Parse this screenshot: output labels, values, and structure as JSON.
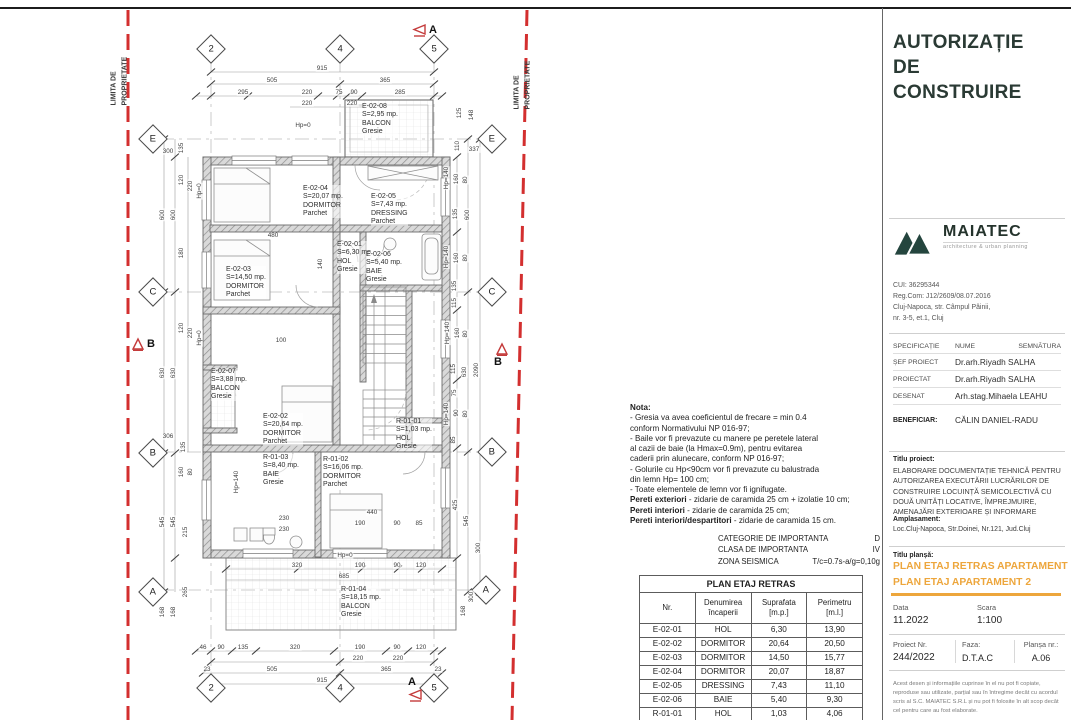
{
  "plan": {
    "property_line_label": "LIMITA DE\nPROPRIETATE",
    "colors": {
      "property_line_red": "#D32F2F",
      "wall_gray": "#6a6a6a"
    },
    "sections": [
      {
        "label": "A"
      },
      {
        "label": "A"
      },
      {
        "label": "B"
      },
      {
        "label": "B"
      }
    ],
    "grid_markers": [
      {
        "label": "2",
        "x": 211,
        "y": 49
      },
      {
        "label": "4",
        "x": 340,
        "y": 49
      },
      {
        "label": "5",
        "x": 434,
        "y": 49
      },
      {
        "label": "2",
        "x": 211,
        "y": 688
      },
      {
        "label": "4",
        "x": 340,
        "y": 688
      },
      {
        "label": "5",
        "x": 434,
        "y": 688
      },
      {
        "label": "E",
        "x": 153,
        "y": 139
      },
      {
        "label": "C",
        "x": 153,
        "y": 292
      },
      {
        "label": "B",
        "x": 153,
        "y": 453
      },
      {
        "label": "A",
        "x": 153,
        "y": 592
      },
      {
        "label": "E",
        "x": 492,
        "y": 139
      },
      {
        "label": "C",
        "x": 492,
        "y": 292
      },
      {
        "label": "B",
        "x": 492,
        "y": 452
      },
      {
        "label": "A",
        "x": 486,
        "y": 590
      }
    ],
    "rooms": [
      {
        "id": "E-02-08",
        "area": "S=2,95 mp.",
        "name": "BALCON",
        "finish": "Gresie",
        "x": 362,
        "y": 103
      },
      {
        "id": "E-02-04",
        "area": "S=20,07 mp.",
        "name": "DORMITOR",
        "finish": "Parchet",
        "x": 303,
        "y": 185
      },
      {
        "id": "E-02-05",
        "area": "S=7,43 mp.",
        "name": "DRESSING",
        "finish": "Parchet",
        "x": 371,
        "y": 193
      },
      {
        "id": "E-02-01",
        "area": "S=6,30 mp.",
        "name": "HOL",
        "finish": "Gresie",
        "x": 337,
        "y": 241
      },
      {
        "id": "E-02-06",
        "area": "S=5,40 mp.",
        "name": "BAIE",
        "finish": "Gresie",
        "x": 366,
        "y": 251
      },
      {
        "id": "E-02-03",
        "area": "S=14,50 mp.",
        "name": "DORMITOR",
        "finish": "Parchet",
        "x": 226,
        "y": 266
      },
      {
        "id": "E-02-07",
        "area": "S=3,88 mp.",
        "name": "BALCON",
        "finish": "Gresie",
        "x": 211,
        "y": 368
      },
      {
        "id": "E-02-02",
        "area": "S=20,64 mp.",
        "name": "DORMITOR",
        "finish": "Parchet",
        "x": 263,
        "y": 413
      },
      {
        "id": "R-01-03",
        "area": "S=8,40 mp.",
        "name": "BAIE",
        "finish": "Gresie",
        "x": 263,
        "y": 454
      },
      {
        "id": "R-01-02",
        "area": "S=16,06 mp.",
        "name": "DORMITOR",
        "finish": "Parchet",
        "x": 323,
        "y": 456
      },
      {
        "id": "R-01-01",
        "area": "S=1,03 mp.",
        "name": "HOL",
        "finish": "Gresie",
        "x": 396,
        "y": 418
      },
      {
        "id": "R-01-04",
        "area": "S=18,15 mp.",
        "name": "BALCON",
        "finish": "Gresie",
        "x": 341,
        "y": 586
      }
    ],
    "dims": [
      {
        "t": "915",
        "x": 322,
        "y": 69
      },
      {
        "t": "505",
        "x": 272,
        "y": 81
      },
      {
        "t": "365",
        "x": 385,
        "y": 81
      },
      {
        "t": "295",
        "x": 243,
        "y": 93
      },
      {
        "t": "220",
        "x": 307,
        "y": 93
      },
      {
        "t": "75",
        "x": 339,
        "y": 93
      },
      {
        "t": "90",
        "x": 354,
        "y": 93
      },
      {
        "t": "285",
        "x": 400,
        "y": 93
      },
      {
        "t": "220",
        "x": 307,
        "y": 104
      },
      {
        "t": "220",
        "x": 352,
        "y": 104
      },
      {
        "t": "337",
        "x": 474,
        "y": 150
      },
      {
        "t": "Hp=0",
        "x": 303,
        "y": 126
      },
      {
        "t": "480",
        "x": 273,
        "y": 236
      },
      {
        "t": "140",
        "x": 321,
        "y": 264,
        "rot": -90
      },
      {
        "t": "100",
        "x": 281,
        "y": 341
      },
      {
        "t": "440",
        "x": 372,
        "y": 513
      },
      {
        "t": "190",
        "x": 360,
        "y": 524
      },
      {
        "t": "90",
        "x": 397,
        "y": 524
      },
      {
        "t": "85",
        "x": 419,
        "y": 524
      },
      {
        "t": "230",
        "x": 284,
        "y": 519
      },
      {
        "t": "230",
        "x": 284,
        "y": 530
      },
      {
        "t": "Hp=0",
        "x": 345,
        "y": 556
      },
      {
        "t": "320",
        "x": 297,
        "y": 566
      },
      {
        "t": "190",
        "x": 360,
        "y": 566
      },
      {
        "t": "90",
        "x": 397,
        "y": 566
      },
      {
        "t": "120",
        "x": 421,
        "y": 566
      },
      {
        "t": "685",
        "x": 344,
        "y": 577
      },
      {
        "t": "46",
        "x": 203,
        "y": 648
      },
      {
        "t": "90",
        "x": 221,
        "y": 648
      },
      {
        "t": "135",
        "x": 243,
        "y": 648
      },
      {
        "t": "320",
        "x": 295,
        "y": 648
      },
      {
        "t": "190",
        "x": 360,
        "y": 648
      },
      {
        "t": "90",
        "x": 397,
        "y": 648
      },
      {
        "t": "120",
        "x": 421,
        "y": 648
      },
      {
        "t": "220",
        "x": 358,
        "y": 659
      },
      {
        "t": "220",
        "x": 398,
        "y": 659
      },
      {
        "t": "23",
        "x": 207,
        "y": 670
      },
      {
        "t": "505",
        "x": 272,
        "y": 670
      },
      {
        "t": "365",
        "x": 386,
        "y": 670
      },
      {
        "t": "23",
        "x": 438,
        "y": 670
      },
      {
        "t": "915",
        "x": 322,
        "y": 681
      },
      {
        "t": "300",
        "x": 168,
        "y": 152
      },
      {
        "t": "135",
        "x": 182,
        "y": 148,
        "rot": -90
      },
      {
        "t": "600",
        "x": 163,
        "y": 215,
        "rot": -90
      },
      {
        "t": "600",
        "x": 174,
        "y": 215,
        "rot": -90
      },
      {
        "t": "120",
        "x": 182,
        "y": 180,
        "rot": -90
      },
      {
        "t": "220",
        "x": 191,
        "y": 186,
        "rot": -90
      },
      {
        "t": "Hp=0",
        "x": 200,
        "y": 191,
        "rot": -90
      },
      {
        "t": "180",
        "x": 182,
        "y": 253,
        "rot": -90
      },
      {
        "t": "120",
        "x": 182,
        "y": 328,
        "rot": -90
      },
      {
        "t": "220",
        "x": 191,
        "y": 333,
        "rot": -90
      },
      {
        "t": "Hp=0",
        "x": 200,
        "y": 338,
        "rot": -90
      },
      {
        "t": "630",
        "x": 163,
        "y": 373,
        "rot": -90
      },
      {
        "t": "630",
        "x": 174,
        "y": 373,
        "rot": -90
      },
      {
        "t": "306",
        "x": 168,
        "y": 437
      },
      {
        "t": "135",
        "x": 184,
        "y": 447,
        "rot": -90
      },
      {
        "t": "160",
        "x": 182,
        "y": 472,
        "rot": -90
      },
      {
        "t": "80",
        "x": 191,
        "y": 472,
        "rot": -90
      },
      {
        "t": "545",
        "x": 163,
        "y": 522,
        "rot": -90
      },
      {
        "t": "545",
        "x": 174,
        "y": 522,
        "rot": -90
      },
      {
        "t": "215",
        "x": 186,
        "y": 532,
        "rot": -90
      },
      {
        "t": "265",
        "x": 186,
        "y": 592,
        "rot": -90
      },
      {
        "t": "168",
        "x": 163,
        "y": 612,
        "rot": -90
      },
      {
        "t": "168",
        "x": 174,
        "y": 612,
        "rot": -90
      },
      {
        "t": "Hp=140",
        "x": 237,
        "y": 482,
        "rot": -90
      },
      {
        "t": "125",
        "x": 460,
        "y": 113,
        "rot": -90
      },
      {
        "t": "148",
        "x": 472,
        "y": 115,
        "rot": -90
      },
      {
        "t": "110",
        "x": 458,
        "y": 146,
        "rot": -90
      },
      {
        "t": "Hp=140",
        "x": 447,
        "y": 178,
        "rot": -90
      },
      {
        "t": "160",
        "x": 457,
        "y": 179,
        "rot": -90
      },
      {
        "t": "80",
        "x": 466,
        "y": 180,
        "rot": -90
      },
      {
        "t": "135",
        "x": 456,
        "y": 214,
        "rot": -90
      },
      {
        "t": "600",
        "x": 468,
        "y": 215,
        "rot": -90
      },
      {
        "t": "Hp=140",
        "x": 447,
        "y": 257,
        "rot": -90
      },
      {
        "t": "160",
        "x": 457,
        "y": 258,
        "rot": -90
      },
      {
        "t": "80",
        "x": 466,
        "y": 258,
        "rot": -90
      },
      {
        "t": "135",
        "x": 455,
        "y": 286,
        "rot": -90
      },
      {
        "t": "115",
        "x": 455,
        "y": 303,
        "rot": -90
      },
      {
        "t": "Hp=140",
        "x": 448,
        "y": 333,
        "rot": -90
      },
      {
        "t": "160",
        "x": 458,
        "y": 333,
        "rot": -90
      },
      {
        "t": "80",
        "x": 466,
        "y": 334,
        "rot": -90
      },
      {
        "t": "115",
        "x": 454,
        "y": 369,
        "rot": -90
      },
      {
        "t": "630",
        "x": 465,
        "y": 372,
        "rot": -90
      },
      {
        "t": "2090",
        "x": 477,
        "y": 370,
        "rot": -90
      },
      {
        "t": "75",
        "x": 455,
        "y": 393,
        "rot": -90
      },
      {
        "t": "Hp=140",
        "x": 447,
        "y": 414,
        "rot": -90
      },
      {
        "t": "90",
        "x": 457,
        "y": 413,
        "rot": -90
      },
      {
        "t": "80",
        "x": 466,
        "y": 414,
        "rot": -90
      },
      {
        "t": "85",
        "x": 454,
        "y": 440,
        "rot": -90
      },
      {
        "t": "425",
        "x": 456,
        "y": 505,
        "rot": -90
      },
      {
        "t": "545",
        "x": 467,
        "y": 521,
        "rot": -90
      },
      {
        "t": "300",
        "x": 479,
        "y": 548,
        "rot": -90
      },
      {
        "t": "300",
        "x": 472,
        "y": 597,
        "rot": -90
      },
      {
        "t": "168",
        "x": 464,
        "y": 611,
        "rot": -90
      }
    ]
  },
  "notes": {
    "title": "Nota:",
    "lines": [
      "- Gresia va avea coeficientul de frecare = min 0.4",
      "conform Normativului NP 016-97;",
      "- Baile vor fi prevazute cu manere pe peretele lateral",
      "al cazii de baie (la Hmax=0.9m), pentru evitarea",
      "caderii prin alunecare, conform NP 016-97;",
      "- Golurile cu Hp<90cm vor fi prevazute cu balustrada",
      "din lemn Hp= 100 cm;",
      "- Toate elementele de lemn vor fi ignifugate."
    ],
    "wall_specs": [
      {
        "b": "Pereti exteriori",
        "r": " - zidarie de caramida 25 cm + izolatie 10 cm;"
      },
      {
        "b": "Pereti interiori",
        "r": " - zidarie de caramida 25 cm;"
      },
      {
        "b": "Pereti interiori/despartitori",
        "r": " - zidarie de caramida 15 cm."
      }
    ],
    "importance": [
      {
        "k": "CATEGORIE DE IMPORTANTA",
        "v": "D"
      },
      {
        "k": "CLASA DE IMPORTANTA",
        "v": "IV"
      },
      {
        "k": "ZONA SEISMICA",
        "v": "T/c=0.7s-a/g=0,10g"
      }
    ]
  },
  "room_table": {
    "title": "PLAN ETAJ RETRAS",
    "headers": [
      "Nr.",
      "Denumirea\nîncaperii",
      "Suprafata\n[m.p.]",
      "Perimetru\n[m.l.]"
    ],
    "rows": [
      [
        "E-02-01",
        "HOL",
        "6,30",
        "13,90"
      ],
      [
        "E-02-02",
        "DORMITOR",
        "20,64",
        "20,50"
      ],
      [
        "E-02-03",
        "DORMITOR",
        "14,50",
        "15,77"
      ],
      [
        "E-02-04",
        "DORMITOR",
        "20,07",
        "18,87"
      ],
      [
        "E-02-05",
        "DRESSING",
        "7,43",
        "11,10"
      ],
      [
        "E-02-06",
        "BAIE",
        "5,40",
        "9,30"
      ],
      [
        "R-01-01",
        "HOL",
        "1,03",
        "4,06"
      ],
      [
        "R-01-02",
        "DORMITOR",
        "16,06",
        "16,10"
      ]
    ]
  },
  "title_block": {
    "permit_title": "AUTORIZAȚIE\nDE\nCONSTRUIRE",
    "brand_color": "#24453E",
    "accent_gold": "#EDA63C",
    "logo_text": "MAIATEC",
    "logo_tagline": "architecture & urban planning",
    "company_lines": [
      "CUI: 36295344",
      "Reg.Com: J12/2609/08.07.2016",
      "Cluj-Napoca, str. Câmpul Pâinii,",
      "nr. 3-5, et.1, Cluj"
    ],
    "spec_headers": {
      "c1": "SPECIFICAȚIE",
      "c2": "NUME",
      "c3": "SEMNĂTURA"
    },
    "spec_rows": [
      {
        "spec": "ȘEF PROIECT",
        "name": "Dr.arh.Riyadh SALHA"
      },
      {
        "spec": "PROIECTAT",
        "name": "Dr.arh.Riyadh SALHA"
      },
      {
        "spec": "DESENAT",
        "name": "Arh.stag.Mihaela LEAHU"
      }
    ],
    "beneficiar_label": "BENEFICIAR:",
    "beneficiar": "CĂLIN DANIEL-RADU",
    "titlu_proiect_label": "Titlu proiect:",
    "titlu_proiect": "ELABORARE DOCUMENTAȚIE TEHNICĂ PENTRU AUTORIZAREA EXECUTĂRII LUCRĂRILOR DE CONSTRUIRE LOCUINȚĂ SEMICOLECTIVĂ CU DOUĂ UNITĂȚI LOCATIVE, ÎMPREJMUIRE, AMENAJĂRI EXTERIOARE ȘI INFORMARE",
    "amplasament_label": "Amplasament:",
    "amplasament": "Loc.Cluj-Napoca, Str.Doinei, Nr.121, Jud.Cluj",
    "titlu_plansa_label": "Titlu planșă:",
    "plansa_line1": "PLAN ETAJ RETRAS APARTAMENT 1",
    "plansa_line2": "PLAN ETAJ APARTAMENT 2",
    "data_label": "Data",
    "data_value": "11.2022",
    "scara_label": "Scara",
    "scara_value": "1:100",
    "proiect_label": "Proiect Nr.",
    "proiect_value": "244/2022",
    "faza_label": "Faza:",
    "faza_value": "D.T.A.C",
    "plansa_nr_label": "Planșa nr.:",
    "plansa_nr_value": "A.06",
    "disclaimer": "Acest desen și informațiile cuprinse în el nu pot fi copiate, reproduse sau utilizate, parțial sau în întregime decât cu acordul scris al S.C. MAIATEC S.R.L și nu pot fi folosite în alt scop decât cel pentru care au fost elaborate."
  }
}
